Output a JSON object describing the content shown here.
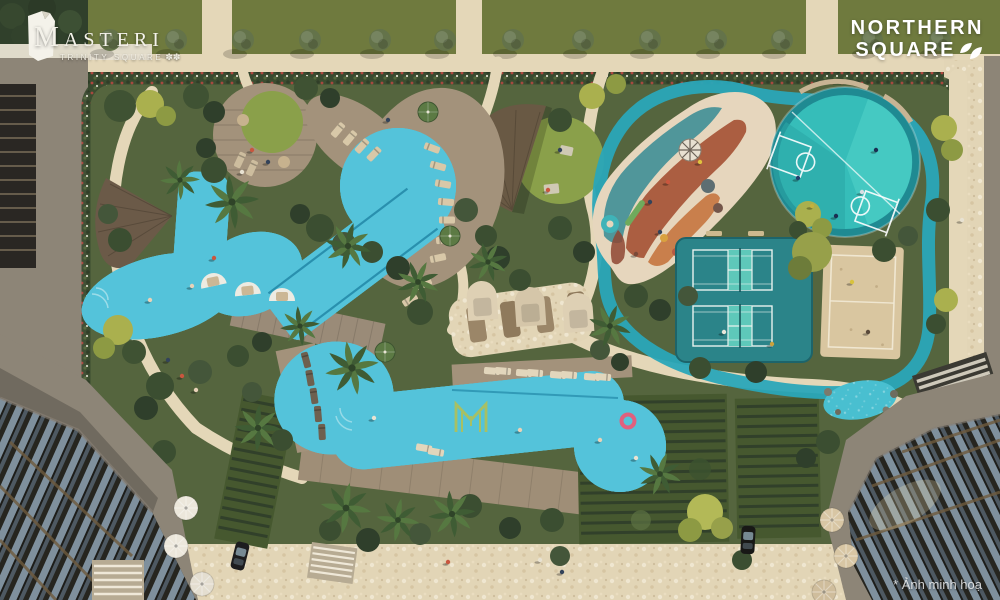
{
  "branding": {
    "masteri": {
      "name": "MASTERI",
      "subtitle": "TRINITY SQUARE",
      "flower_icon": "✽✽"
    },
    "northern_square": {
      "line1": "NORTHERN",
      "line2": "SQUARE"
    }
  },
  "caption": "* Ảnh minh hoạ",
  "palette": {
    "pool": "#54c3da",
    "pool_deep": "#2f9fc2",
    "track": "#2aa7b8",
    "lawn": "#6f7a3e",
    "lawn_bright": "#8aa04a",
    "path": "#e4d7b8",
    "deck": "#a3927b",
    "greenery": "#55653e",
    "hedge": "#3a4a2f",
    "sand": "#d9c6a0",
    "tennis_base": "#2b8489",
    "tennis_court": "#5ec8ba",
    "basketball": "#36bdb9",
    "basketball_ring": "#1f8a92",
    "playground_cream": "#e6d6bd",
    "playground_rust": "#a8573a",
    "playground_teal": "#3f8f96",
    "playground_orange": "#c5763f",
    "pergola": "#46582f",
    "building": "#23221e",
    "road": "#8d8577",
    "water_feature": "#49bfd0"
  }
}
